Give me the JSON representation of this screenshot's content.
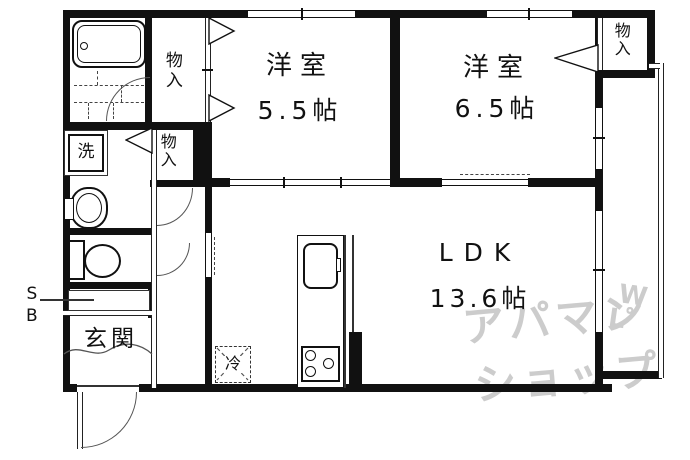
{
  "rooms": {
    "western1": {
      "name": "洋室",
      "size": "5.5帖"
    },
    "western2": {
      "name": "洋室",
      "size": "6.5帖"
    },
    "ldk": {
      "name": "LDK",
      "size": "13.6帖"
    }
  },
  "closets": {
    "top_left": "物入",
    "mid_left": "物入",
    "top_right": "物入"
  },
  "fixtures": {
    "washer": "洗",
    "fridge": "冷",
    "shoe_box": "SB",
    "entrance": "玄関"
  },
  "watermark": {
    "line1": "アパマン",
    "line2": "ショップ",
    "mark_top": "W",
    "mark_bottom": "L",
    "mark_dot": "゜"
  },
  "icons": {
    "bathtub": "double-rounded-rect-with-drain-circle",
    "bath-tile": "dashed-brick-lines",
    "washbasin": "oval-bowl-shape",
    "toilet": "tank-rect-and-bowl-ellipse",
    "kitchen-sink": "rounded-rect",
    "stove": "rect-with-3-burner-circles",
    "fridge": "dashed-box-with-x",
    "closet-door": "hollow-triangle",
    "swing-door": "quarter-circle-arc",
    "window": "double-line-band"
  },
  "colors": {
    "wall": "#111111",
    "line": "#555555",
    "watermark": "#cccccc",
    "background": "#ffffff"
  }
}
